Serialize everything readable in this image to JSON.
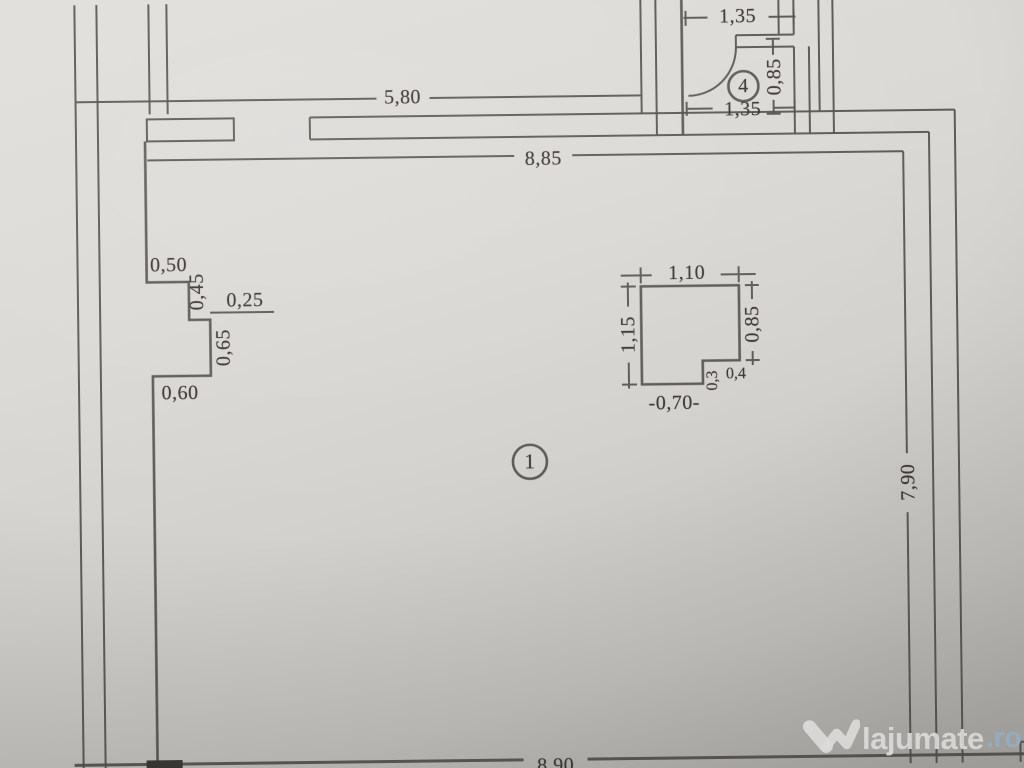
{
  "document": {
    "kind": "apartment floor plan photo"
  },
  "colors": {
    "paper": "#d7d5d1",
    "ink": "#53504b",
    "watermark_text": "#f6f5f3",
    "watermark_tld": "#a9c2d8"
  },
  "rooms": {
    "main": {
      "number": "1"
    },
    "small": {
      "number": "4"
    }
  },
  "dimensions": {
    "top_wall": "5,80",
    "main_width": "8,85",
    "main_height": "7,90",
    "bottom_width": "8,90",
    "room4_top": "1,35",
    "room4_bottom": "1,35",
    "room4_side": "0,85",
    "step_a": "0,50",
    "step_b": "0,45",
    "step_c": "0,25",
    "step_d": "0,65",
    "step_e": "0,60",
    "column_top": "1,10",
    "column_left": "1,15",
    "column_right": "0,85",
    "column_notch_w": "0,4",
    "column_notch_h": "0,3",
    "column_bottom": "-0,70-"
  },
  "watermark": {
    "brand": "lajumate",
    "tld": ".ro"
  }
}
